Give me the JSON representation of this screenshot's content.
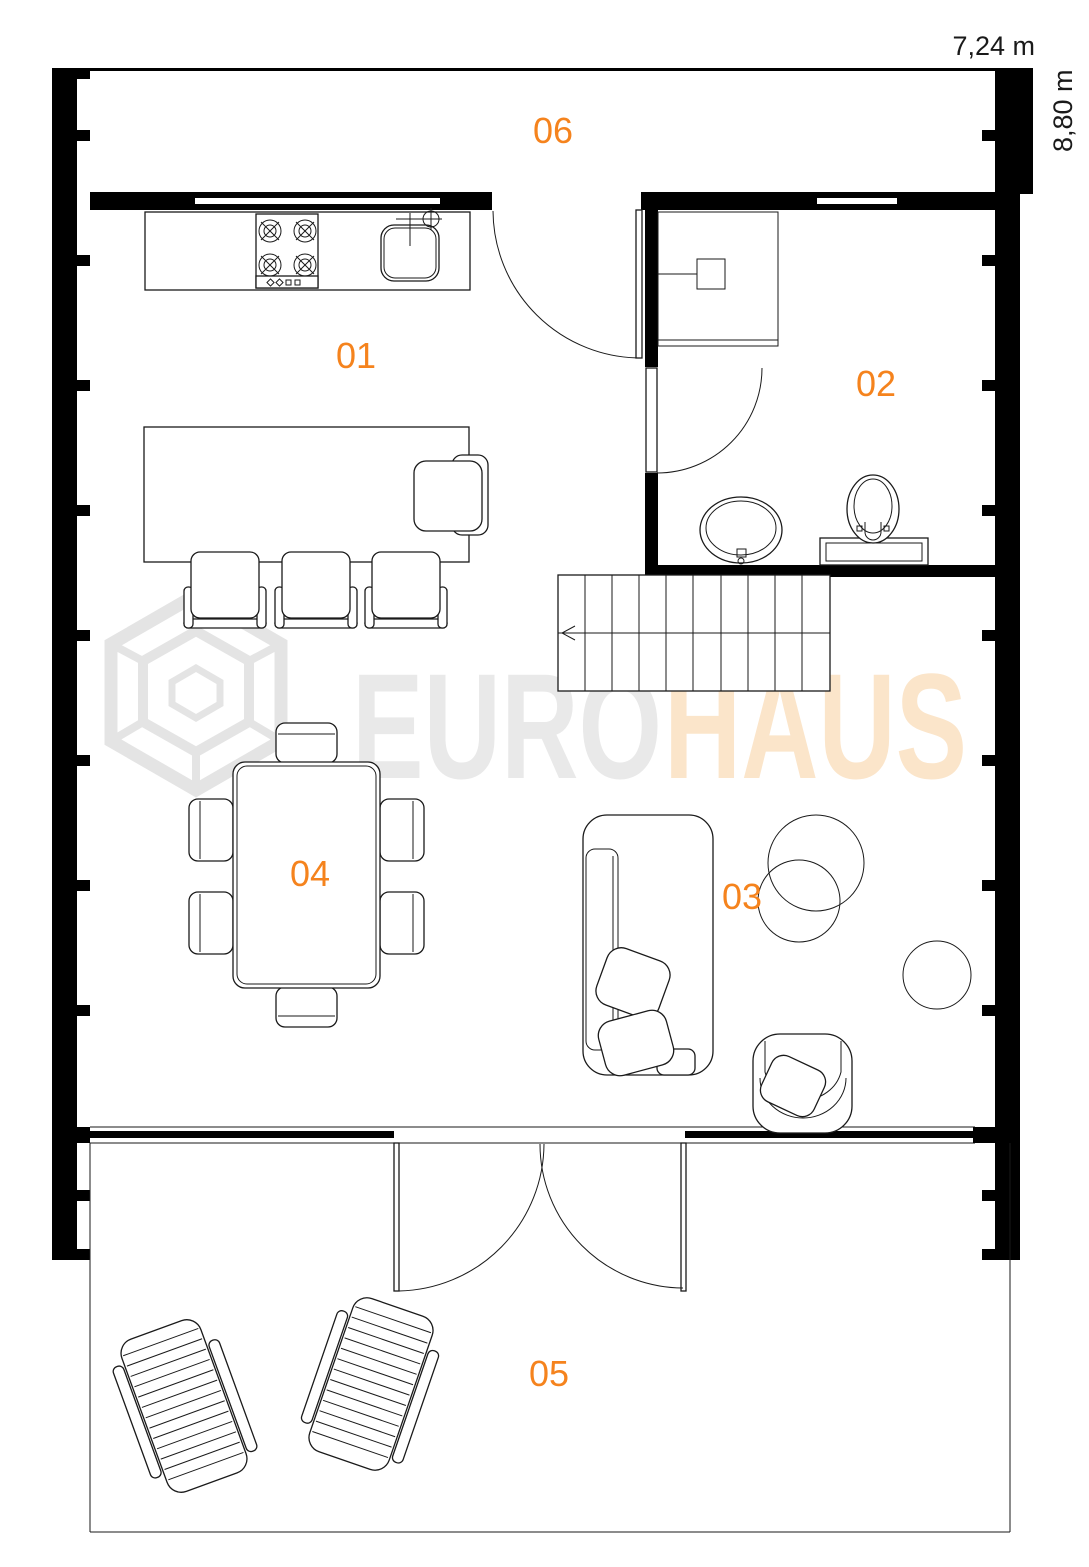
{
  "plan": {
    "dimensions": {
      "width_label": "7,24 m",
      "height_label": "8,80 m"
    },
    "rooms": [
      {
        "id": "01",
        "label": "01"
      },
      {
        "id": "02",
        "label": "02"
      },
      {
        "id": "03",
        "label": "03"
      },
      {
        "id": "04",
        "label": "04"
      },
      {
        "id": "05",
        "label": "05"
      },
      {
        "id": "06",
        "label": "06"
      }
    ],
    "watermark": {
      "euro": "EURO",
      "haus": "HAUS"
    },
    "colors": {
      "label_orange": "#F5831D",
      "watermark_gray": "#E9E9E9",
      "watermark_peach": "#FBE5CA",
      "wall_black": "#000000"
    }
  }
}
